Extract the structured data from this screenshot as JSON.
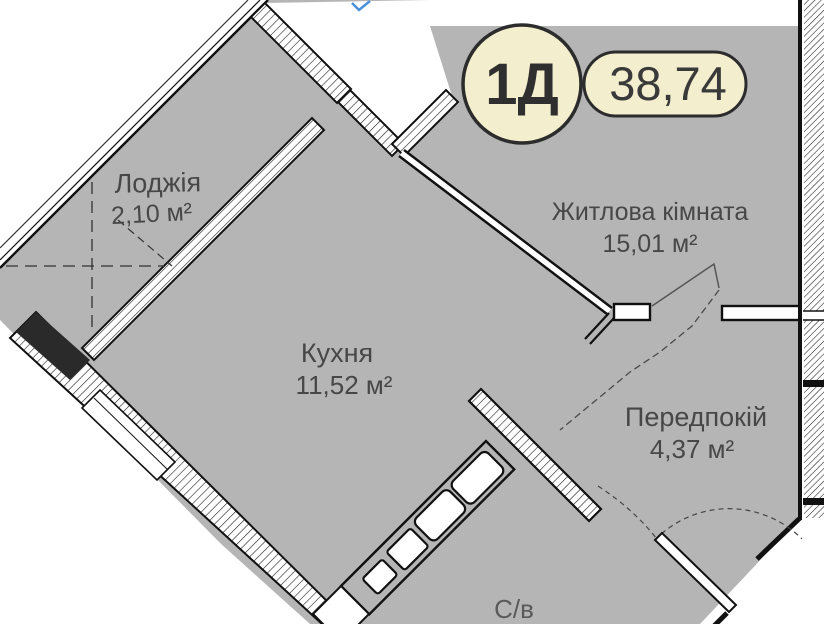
{
  "plan": {
    "badge": {
      "unit_type": "1Д",
      "total_area": "38,74"
    },
    "rooms": [
      {
        "id": "loggia",
        "name": "Лоджія",
        "area": "2,10 м²"
      },
      {
        "id": "living-room",
        "name": "Житлова кімната",
        "area": "15,01 м²"
      },
      {
        "id": "kitchen",
        "name": "Кухня",
        "area": "11,52 м²"
      },
      {
        "id": "hallway",
        "name": "Передпокій",
        "area": "4,37 м²"
      },
      {
        "id": "bathroom",
        "name": "С/в"
      }
    ],
    "colors": {
      "interior_fill": "#b5b5b5",
      "wall": "#1a1a1a",
      "badge_fill": "#f3eecd",
      "badge_border": "#2c2c2c",
      "label_text": "#474747",
      "north_mark_blue": "#4a90d8"
    }
  }
}
